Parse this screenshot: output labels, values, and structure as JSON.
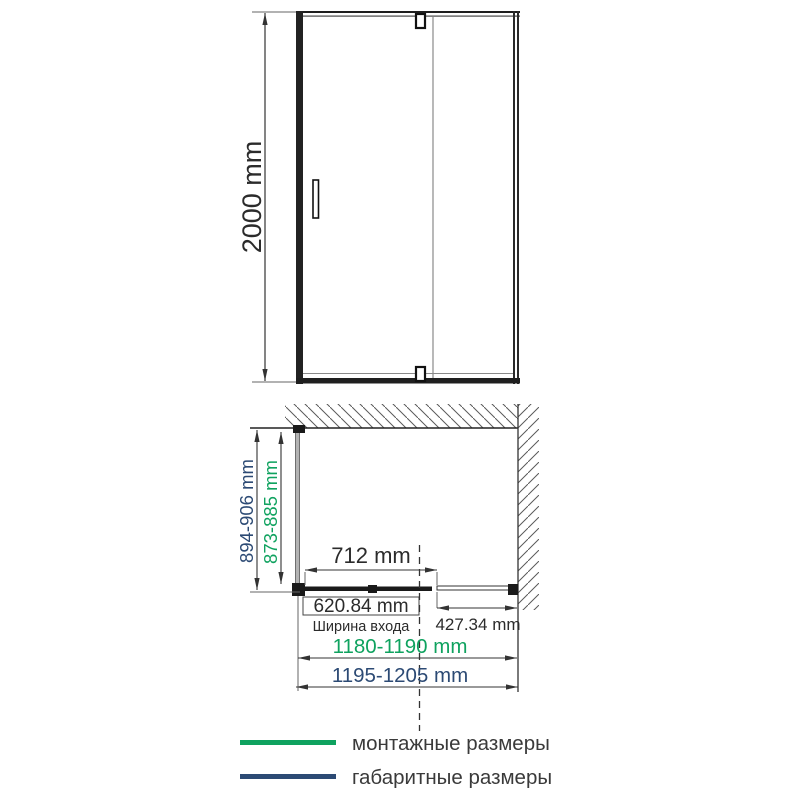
{
  "front_view": {
    "height_label": "2000 mm"
  },
  "plan_view": {
    "overall_depth_label": "894-906 mm",
    "mounting_depth_label": "873-885 mm",
    "pivot_width_label": "712 mm",
    "entrance_width_label": "620.84 mm",
    "entrance_caption": "Ширина входа",
    "fixed_panel_width_label": "427.34 mm",
    "mounting_width_label": "1180-1190 mm",
    "overall_width_label": "1195-1205 mm"
  },
  "legend": {
    "mounting_label": "монтажные размеры",
    "overall_label": "габаритные размеры"
  },
  "colors": {
    "mounting_green": "#0fa25f",
    "overall_navy": "#2c4a74",
    "drawing_line": "#1f1f1f",
    "text_dark": "#3a3a3a"
  }
}
